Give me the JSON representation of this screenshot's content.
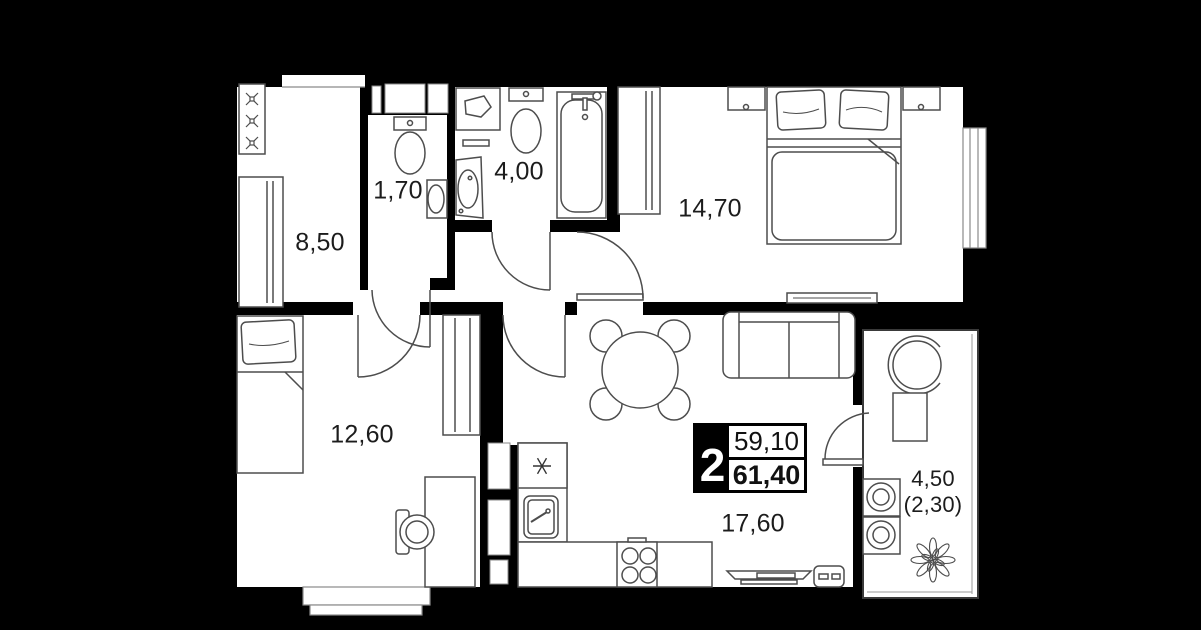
{
  "floor_plan": {
    "title": "2-room apartment floor plan",
    "summary": {
      "rooms_count": "2",
      "area_primary": "59,10",
      "area_total": "61,40"
    },
    "rooms": {
      "hallway": {
        "label": "8,50"
      },
      "wc": {
        "label": "1,70"
      },
      "bathroom": {
        "label": "4,00"
      },
      "bedroom": {
        "label": "14,70"
      },
      "room": {
        "label": "12,60"
      },
      "kitchen_living": {
        "label": "17,60"
      },
      "balcony": {
        "label": "4,50",
        "label_secondary": "(2,30)"
      }
    },
    "colors": {
      "background": "#000000",
      "walls": "#000000",
      "floor": "#ffffff",
      "furniture_line": "#4d4d4d"
    }
  }
}
